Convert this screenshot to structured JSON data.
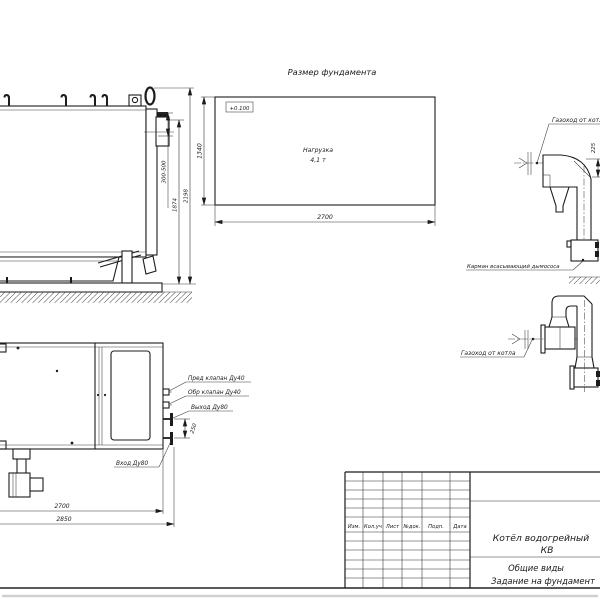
{
  "colors": {
    "line": "#1a1a1a",
    "background": "#ffffff",
    "frame_gray": "#d0d0d0"
  },
  "side_view": {
    "dim_flange_height": "300-500",
    "dim_body_height": "1874",
    "dim_total_height": "2198"
  },
  "foundation": {
    "title": "Размер фундамента",
    "level_mark": "+0.100",
    "load_line1": "Нагрузка",
    "load_line2": "4,1 т",
    "dim_width": "2700",
    "dim_depth": "1340"
  },
  "flue_side": {
    "duct_label": "Газоход от котла",
    "pocket_label": "Карман всасывающий дымососа",
    "dim_offset": "225"
  },
  "flue_front": {
    "duct_label": "Газоход от котла"
  },
  "plan_view": {
    "safety_valve_label": "Пред клапан Ду40",
    "check_valve_label": "Обр клапан Ду40",
    "outlet_label": "Выход Ду80",
    "inlet_label": "Вход Ду80",
    "dim_nozzle_spacing": "250",
    "dim_body_length": "2700",
    "dim_total_length": "2850"
  },
  "title_block": {
    "columns": [
      "Изм.",
      "Кол.уч",
      "Лист",
      "№док.",
      "Подп.",
      "Дата"
    ],
    "product_line1": "Котёл водогрейный",
    "product_line2": "КВ",
    "doc_type_line1": "Общие виды",
    "doc_type_line2": "Задание на фундамент"
  }
}
